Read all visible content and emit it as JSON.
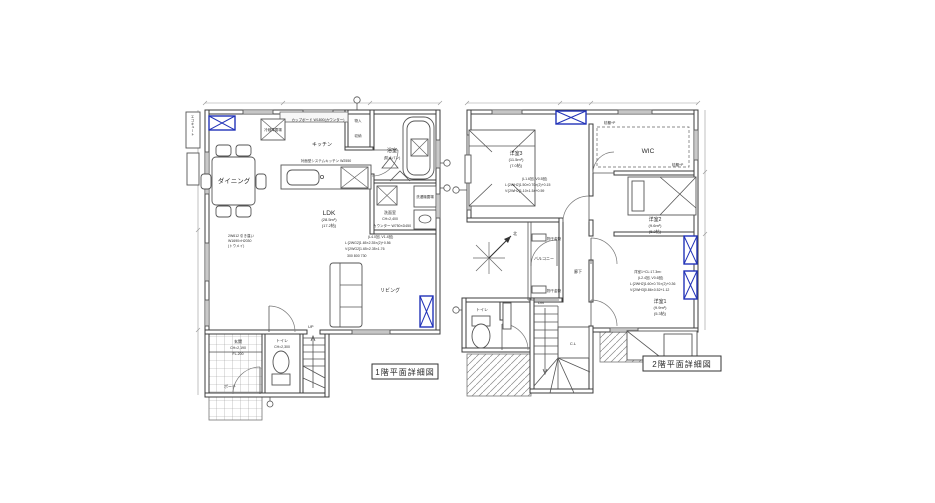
{
  "drawing": {
    "type": "architectural-floor-plan",
    "accent_blue": "#2233b8",
    "line_color": "#3c3c3c",
    "background": "#ffffff"
  },
  "floor1": {
    "title": "1階平面詳細図",
    "labels": {
      "dining": "ダイニング",
      "kitchen": "キッチン",
      "kitchen_note": "対面型システムキッチン W2550",
      "cupboard": "カップボード W1800(カウンター)",
      "fridge": "冷蔵庫置場",
      "closet_upper": "物入",
      "closet_lower": "収納",
      "bath": "浴室",
      "bath_note": "(防水パン)",
      "washroom": "洗面室",
      "washroom_ch": "CH=2,400",
      "washer": "洗濯機置場",
      "counter_note": "カウンター W750×D450",
      "ldk": "LDK",
      "ldk_area": "(28.5m²)",
      "ldk_tatami": "(17.2帖)",
      "glazing1": "(L4.0回, V1.4回)",
      "glazing2": "L:[2WG2]1.65×2.35×(2)+0.56",
      "glazing3": "V:[2WG2]1.65×2.35×1.76",
      "dims_note": "300   800   730",
      "sliding1": "2W612 引き違い",
      "sliding2": "W1690×H2030",
      "sliding3": "(トウメイ)",
      "living": "リビング",
      "toilet": "トイレ",
      "toilet_ch": "CH=2,300",
      "entrance": "玄関",
      "entrance_ch": "CH=2,190",
      "entrance_fl": "FL-200",
      "porch": "ポーチ",
      "up": "UP",
      "ecocute": "エコキュート"
    }
  },
  "floor2": {
    "title": "2階平面詳細図",
    "labels": {
      "room3": "洋室3",
      "room3_area": "(11.5m²)",
      "room3_tatami": "(7.0帖)",
      "room3_g1": "(L1.6回, V0.5回)",
      "room3_g2": "L:[2WH2]1.50×0.70×(2)+0.15",
      "room3_g3": "V:[2WH2]1.10×1.54+0.59",
      "wic": "WIC",
      "wic_shelf1": "枕棚+P",
      "wic_shelf2": "枕棚+P",
      "room2": "洋室2",
      "room2_area": "(9.6m²)",
      "room2_tatami": "(5.2帖)",
      "room1_calc": "洋室1+CL:17.3m²",
      "room1_g1": "(L2.4回, V0.6回)",
      "room1_g2": "L:[2WH2]1.60×0.70×(2)+0.36",
      "room1_g3": "V:[2WH3]0.86×0.52+1.12",
      "room1": "洋室1",
      "room1_area": "(9.9m²)",
      "room1_tatami": "(5.3帖)",
      "corridor": "廊下",
      "balcony": "バルコニー",
      "hoshi1": "物干金物",
      "hoshi2": "物干金物",
      "toilet": "トイレ",
      "cl": "C.L",
      "dn": "DN",
      "north": "北"
    }
  }
}
